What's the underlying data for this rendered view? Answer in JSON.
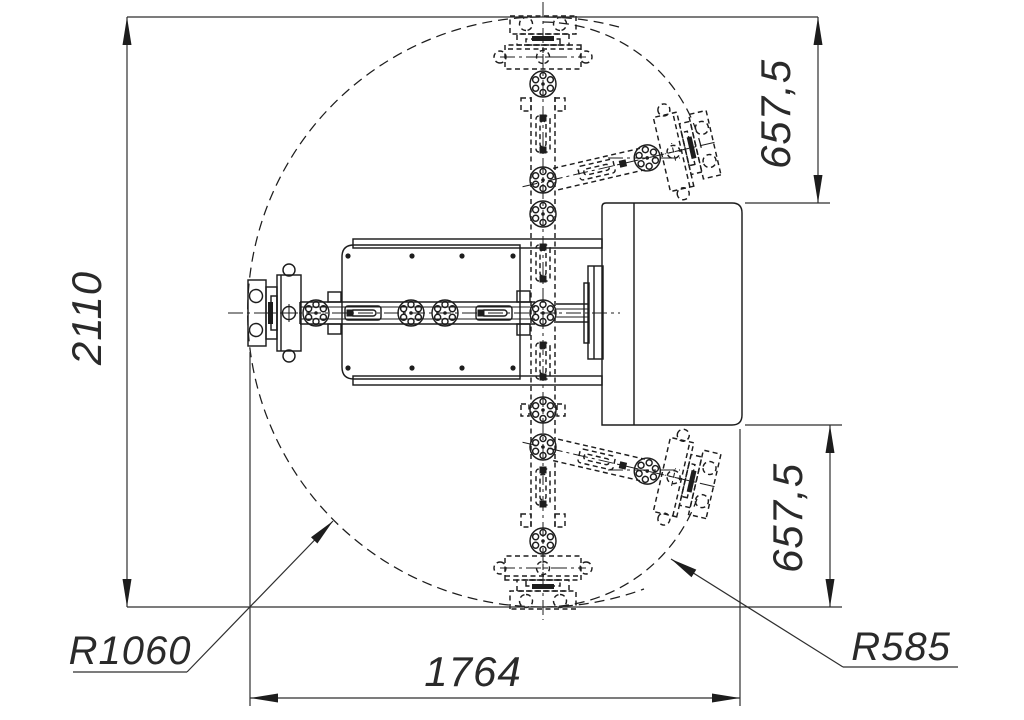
{
  "drawing": {
    "type": "engineering-top-view",
    "line_color": "#1d1d1d",
    "background_color": "#ffffff",
    "dimensions": {
      "overall_height": "2110",
      "upper_offset": "657,5",
      "lower_offset": "657,5",
      "overall_width": "1764",
      "radius_large": "R1060",
      "radius_small": "R585"
    }
  }
}
